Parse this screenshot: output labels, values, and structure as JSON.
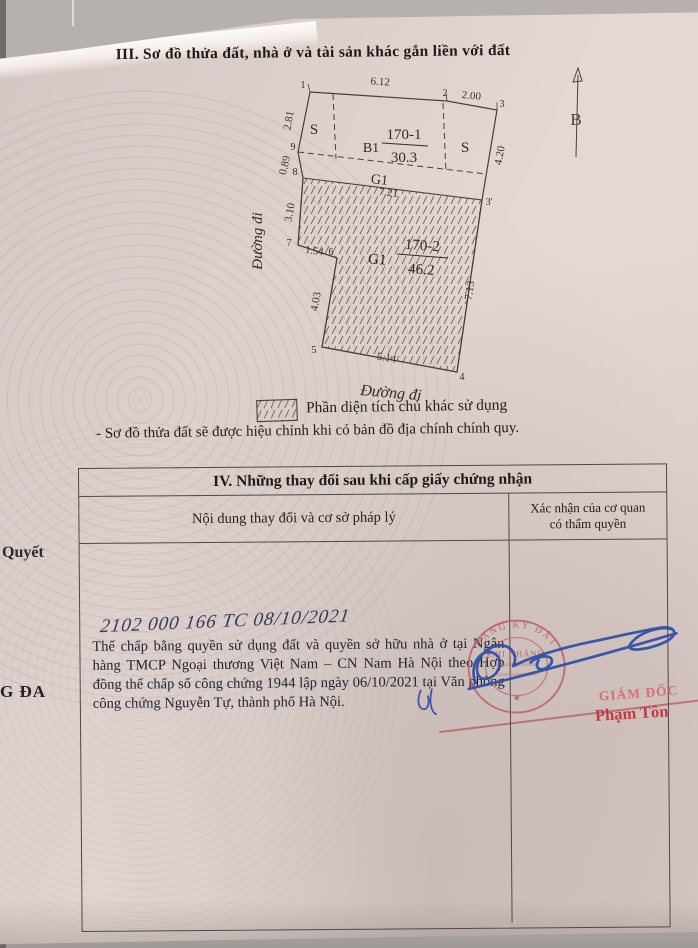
{
  "section3": {
    "title": "III. Sơ đồ thửa đất, nhà ở và tài sản khác gắn liền với đất",
    "diagram": {
      "north_label": "B",
      "road_left": "Đường đi",
      "road_bottom": "Đường đi",
      "labels": {
        "s_left": "S",
        "s_right": "S",
        "b1": "B1",
        "g1_strip": "G1",
        "g1_plot": "G1",
        "plot1_number": "170-1",
        "plot1_area": "30.3",
        "plot2_number": "170-2",
        "plot2_area": "46.2"
      },
      "dims": {
        "d612": "6.12",
        "d200": "2.00",
        "d281": "2.81",
        "d420": "4.20",
        "d089": "0.89",
        "d310": "3.10",
        "d154": "1.54",
        "d403": "4.03",
        "d713": "7.13",
        "d514": "5.14",
        "d721": "7.21"
      },
      "points": {
        "p1": "1",
        "p2": "2",
        "p3": "3",
        "p3b": "3'",
        "p4": "4",
        "p5": "5",
        "p6": "6",
        "p7": "7",
        "p8": "8",
        "p9": "9"
      }
    },
    "legend": "Phần diện tích chủ khác sử dụng",
    "note": "- Sơ đồ thửa đất sẽ được hiệu chỉnh khi có bản đồ địa chính chính quy."
  },
  "section4": {
    "title": "IV. Những thay đổi sau khi cấp giấy chứng nhận",
    "col1": "Nội dung thay đổi và cơ sở pháp lý",
    "col2_line1": "Xác nhận của cơ quan",
    "col2_line2": "có thẩm quyền",
    "entry": {
      "handwritten": "2102 000 166 TC 08/10/2021",
      "body": "Thế chấp bằng quyền sử dụng đất và quyền sở hữu nhà ở tại Ngân hàng TMCP Ngoại thương Việt Nam – CN Nam Hà Nội theo Hợp đồng thế chấp số công chứng 1944 lập ngày 06/10/2021 tại Văn phòng công chứng Nguyễn Tự, thành phố Hà Nội."
    },
    "stamp": {
      "arc_top": "ĐĂNG KÝ ĐẤT",
      "center": "CHI NHÁNH",
      "star": "★"
    },
    "approval": {
      "role": "GIÁM ĐỐC",
      "name": "Phạm Tôn"
    }
  },
  "margin": {
    "fragment_top": "Quyết",
    "fragment_bottom": "G ĐA"
  }
}
